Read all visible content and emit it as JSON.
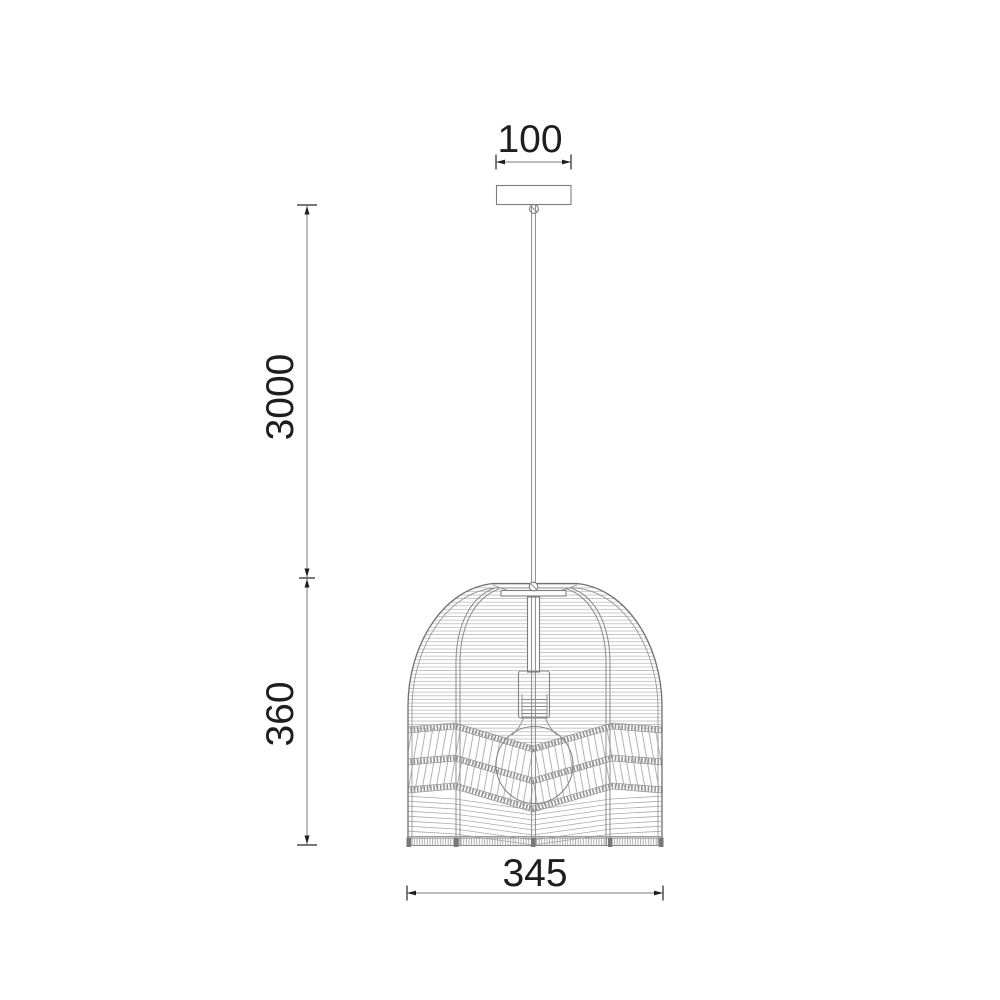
{
  "meta": {
    "type": "technical-dimension-drawing",
    "subject": "rattan dome pendant light"
  },
  "dimensions": {
    "canopy_width": "100",
    "suspension_length": "3000",
    "shade_height": "360",
    "shade_width": "345"
  },
  "colors": {
    "background": "#ffffff",
    "dimension_text": "#1e1e1e",
    "dimension_line": "#7b7b7b",
    "drawing_outline": "#6f6f6f",
    "weave_texture": "#b2b2b2"
  }
}
